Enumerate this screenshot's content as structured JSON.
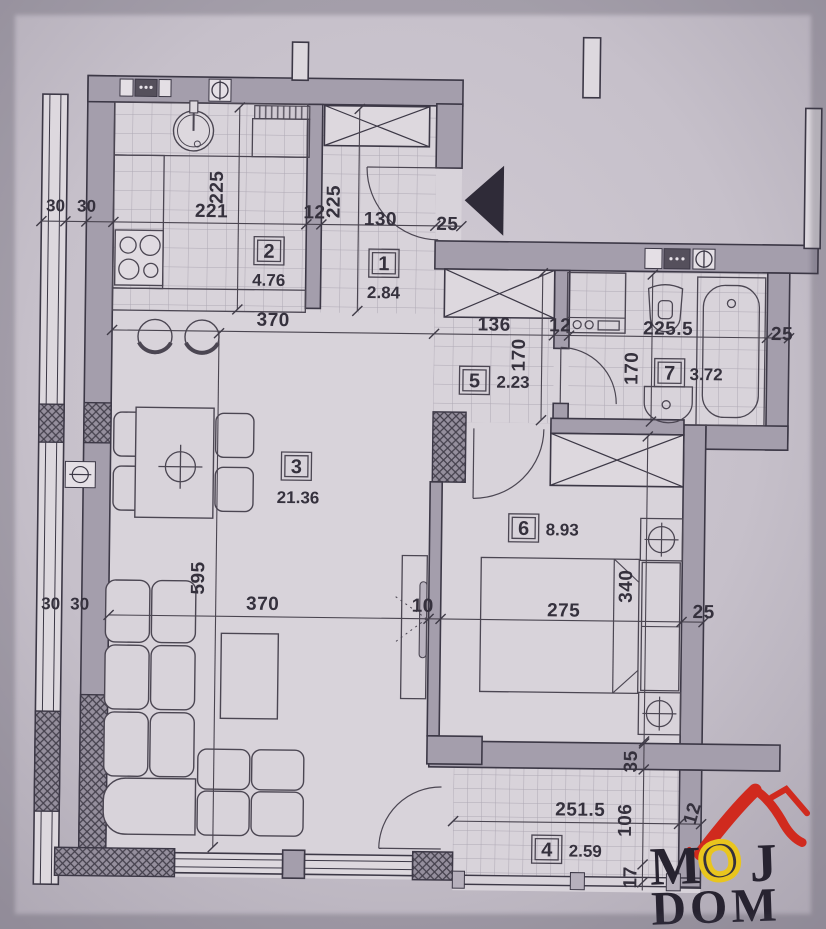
{
  "plan_title": "Apartment floor plan",
  "rooms": [
    {
      "num": "1",
      "area": "2.84"
    },
    {
      "num": "2",
      "area": "4.76"
    },
    {
      "num": "3",
      "area": "21.36"
    },
    {
      "num": "4",
      "area": "2.59"
    },
    {
      "num": "5",
      "area": "2.23"
    },
    {
      "num": "6",
      "area": "8.93"
    },
    {
      "num": "7",
      "area": "3.72"
    }
  ],
  "dims": {
    "t30a": "30",
    "t30b": "30",
    "k221": "221",
    "k225": "225",
    "kw12": "12",
    "h225": "225",
    "h130": "130",
    "h25": "25",
    "m370": "370",
    "m136": "136",
    "m12": "12",
    "m2255": "225.5",
    "m25": "25",
    "hall170": "170",
    "bath170": "170",
    "v595": "595",
    "l370": "370",
    "p10": "10",
    "b275": "275",
    "b25": "25",
    "b340": "340",
    "l30a": "30",
    "l30b": "30",
    "w35": "35",
    "t2515": "251.5",
    "t106": "106",
    "tw12": "12",
    "w17": "17"
  },
  "logo": {
    "m": "M",
    "o": "O",
    "j": "J",
    "word2": "DOM"
  },
  "colors": {
    "paper": "#c2bcc6",
    "floor": "#d8d3da",
    "wall": "#a49eac",
    "line": "#3c3846",
    "logo_red": "#d02a1e",
    "logo_yellow": "#e9c51e",
    "logo_black": "#272330"
  },
  "icons": [
    "entrance-arrow-icon",
    "sink-icon",
    "stove-icon",
    "bathtub-icon",
    "toilet-icon",
    "washer-icon",
    "bed-icon",
    "sofa-icon",
    "wardrobe-icon",
    "ceiling-light-icon",
    "radiator-icon",
    "vent-icon"
  ]
}
